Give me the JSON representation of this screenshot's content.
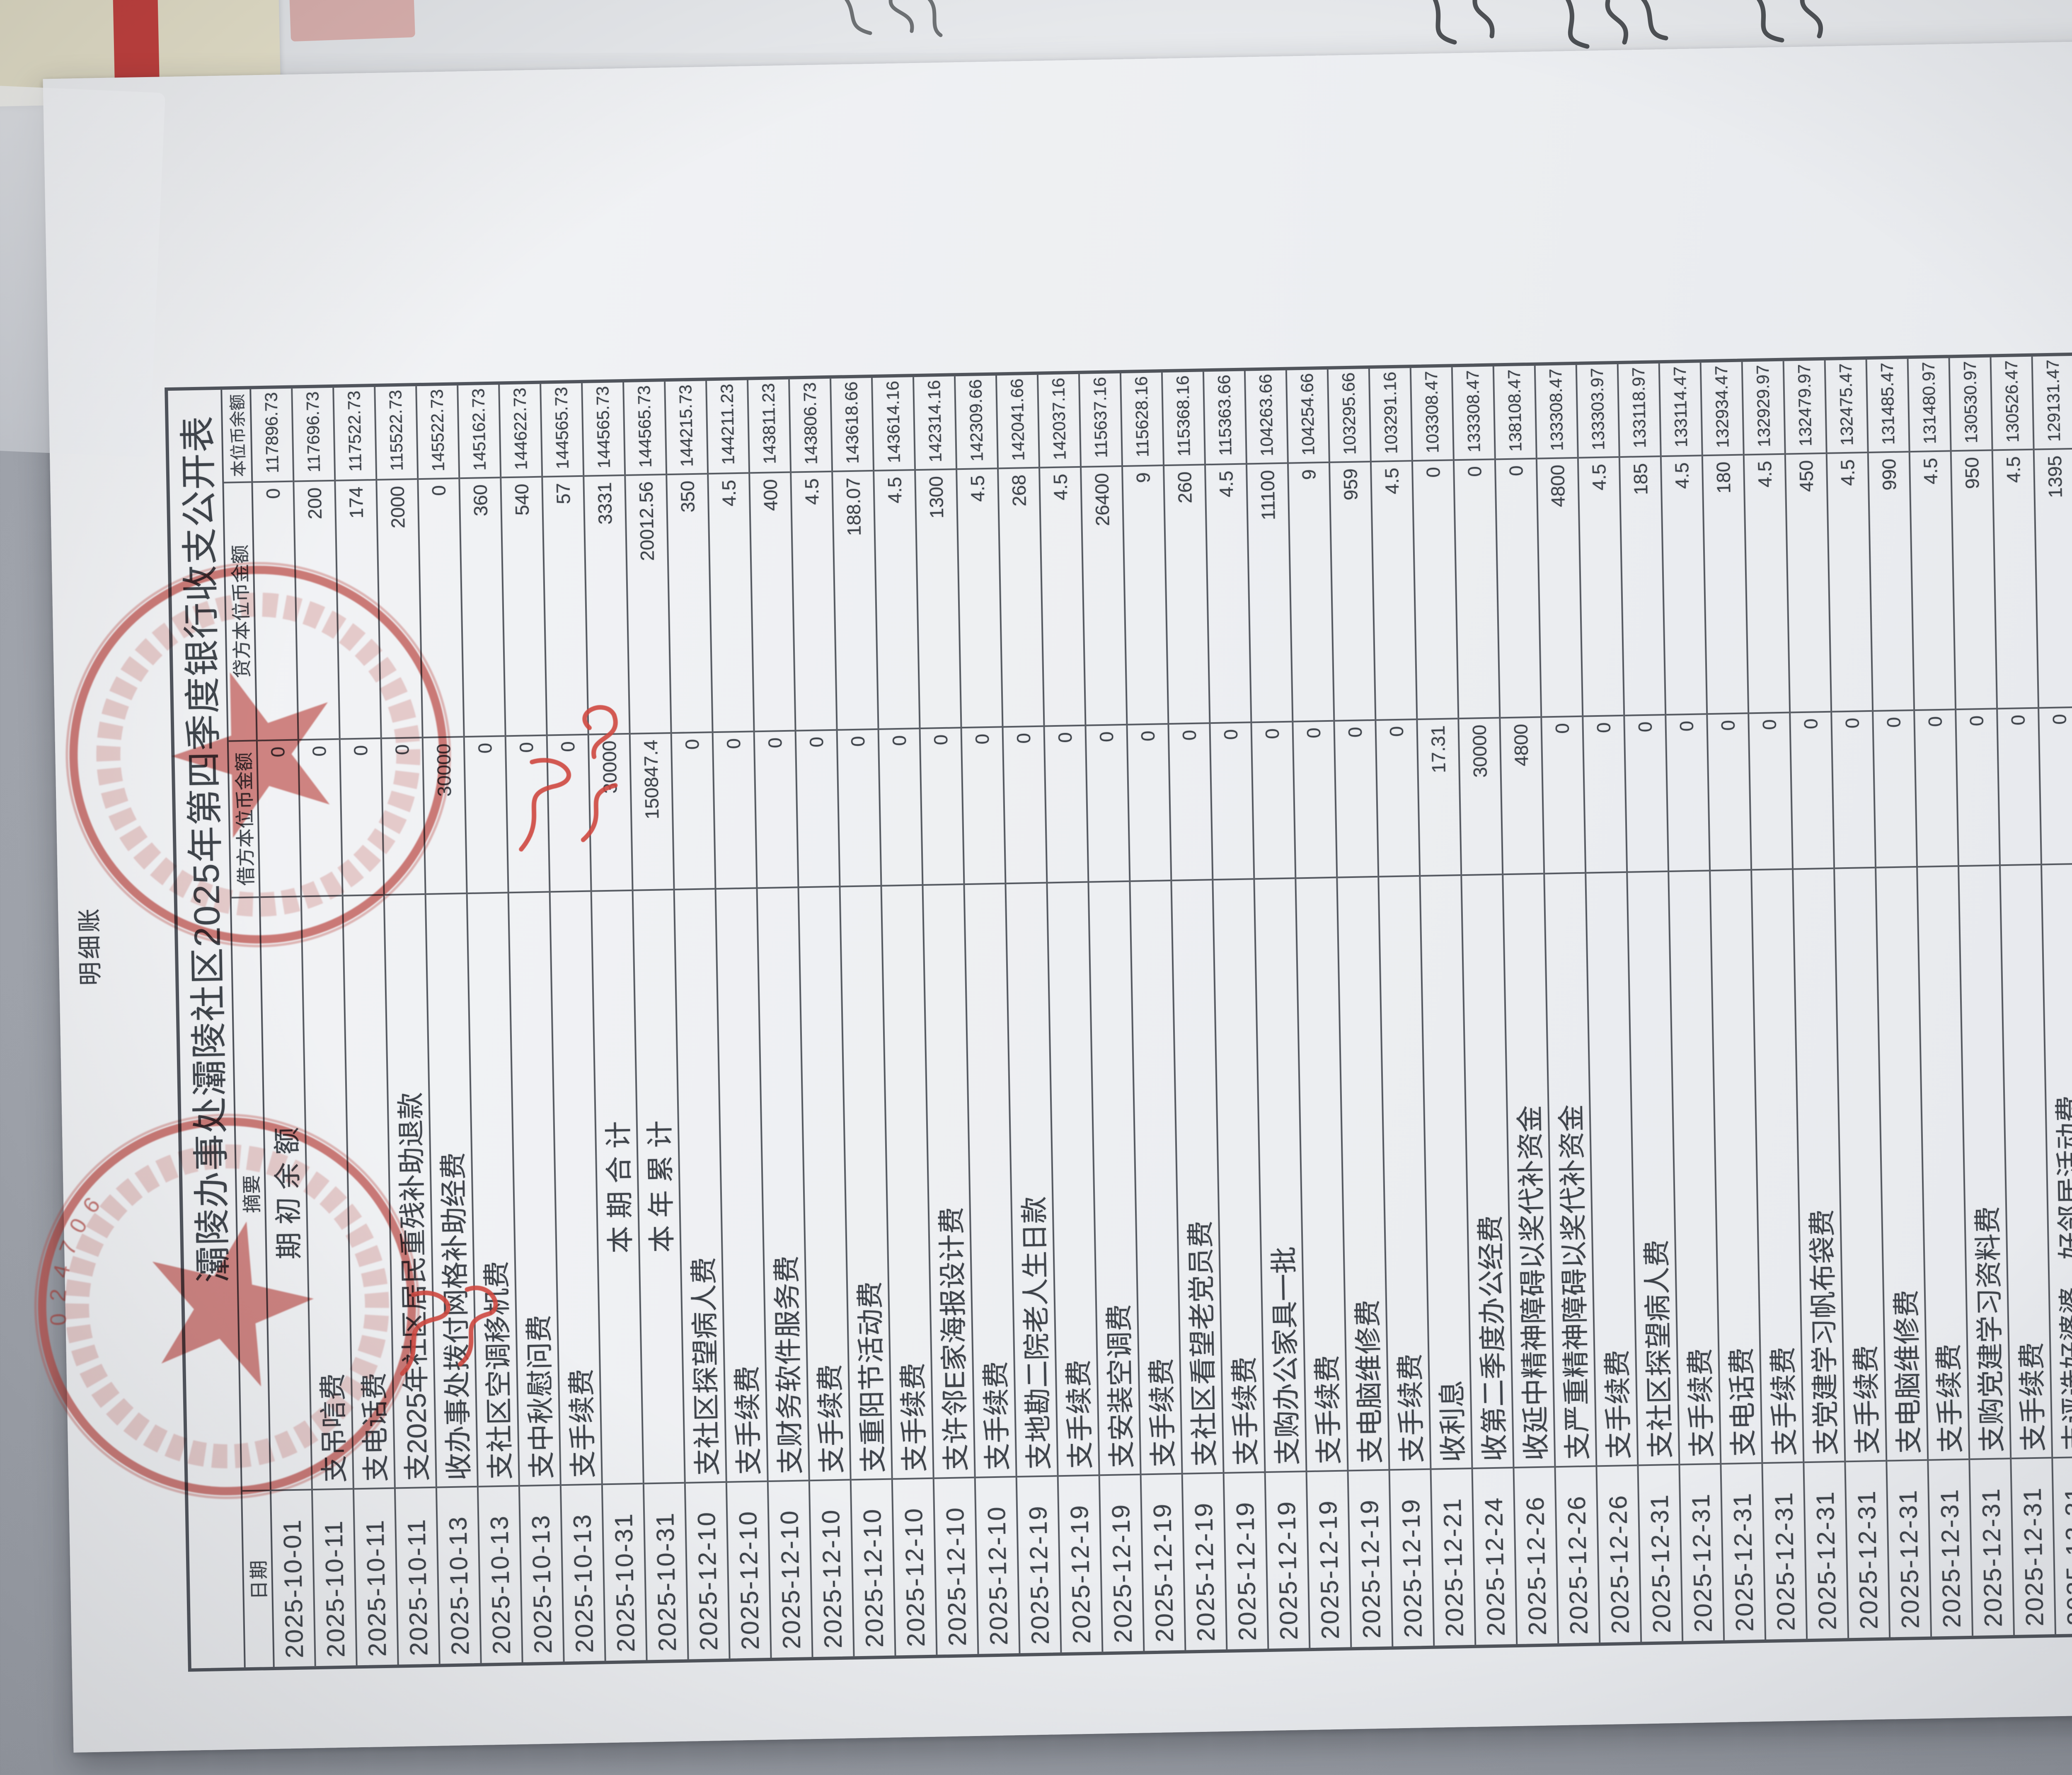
{
  "document": {
    "title": "灞陵办事处灞陵社区2025年第四季度银行收支公开表",
    "columns": [
      "日期",
      "摘要",
      "借方本位币金额",
      "贷方本位币金额",
      "本位币余额"
    ],
    "rows": [
      {
        "date": "2025-10-01",
        "summary": "期 初 余 额",
        "debit": "0",
        "credit": "0",
        "balance": "117896.73",
        "center": true
      },
      {
        "date": "2025-10-11",
        "summary": "支吊唁费",
        "debit": "0",
        "credit": "200",
        "balance": "117696.73"
      },
      {
        "date": "2025-10-11",
        "summary": "支电话费",
        "debit": "0",
        "credit": "174",
        "balance": "117522.73"
      },
      {
        "date": "2025-10-11",
        "summary": "支2025年社区居民重残补助退款",
        "debit": "0",
        "credit": "2000",
        "balance": "115522.73"
      },
      {
        "date": "2025-10-13",
        "summary": "收办事处拨付网格补助经费",
        "debit": "30000",
        "credit": "0",
        "balance": "145522.73"
      },
      {
        "date": "2025-10-13",
        "summary": "支社区空调移机费",
        "debit": "0",
        "credit": "360",
        "balance": "145162.73"
      },
      {
        "date": "2025-10-13",
        "summary": "支中秋慰问费",
        "debit": "0",
        "credit": "540",
        "balance": "144622.73"
      },
      {
        "date": "2025-10-13",
        "summary": "支手续费",
        "debit": "0",
        "credit": "57",
        "balance": "144565.73"
      },
      {
        "date": "2025-10-31",
        "summary": "本 期 合 计",
        "debit": "30000",
        "credit": "3331",
        "balance": "144565.73",
        "center": true
      },
      {
        "date": "2025-10-31",
        "summary": "本 年 累 计",
        "debit": "150847.4",
        "credit": "20012.56",
        "balance": "144565.73",
        "center": true
      },
      {
        "date": "2025-12-10",
        "summary": "支社区探望病人费",
        "debit": "0",
        "credit": "350",
        "balance": "144215.73"
      },
      {
        "date": "2025-12-10",
        "summary": "支手续费",
        "debit": "0",
        "credit": "4.5",
        "balance": "144211.23"
      },
      {
        "date": "2025-12-10",
        "summary": "支财务软件服务费",
        "debit": "0",
        "credit": "400",
        "balance": "143811.23"
      },
      {
        "date": "2025-12-10",
        "summary": "支手续费",
        "debit": "0",
        "credit": "4.5",
        "balance": "143806.73"
      },
      {
        "date": "2025-12-10",
        "summary": "支重阳节活动费",
        "debit": "0",
        "credit": "188.07",
        "balance": "143618.66"
      },
      {
        "date": "2025-12-10",
        "summary": "支手续费",
        "debit": "0",
        "credit": "4.5",
        "balance": "143614.16"
      },
      {
        "date": "2025-12-10",
        "summary": "支许邻E家海报设计费",
        "debit": "0",
        "credit": "1300",
        "balance": "142314.16"
      },
      {
        "date": "2025-12-10",
        "summary": "支手续费",
        "debit": "0",
        "credit": "4.5",
        "balance": "142309.66"
      },
      {
        "date": "2025-12-19",
        "summary": "支地勘二院老人生日款",
        "debit": "0",
        "credit": "268",
        "balance": "142041.66"
      },
      {
        "date": "2025-12-19",
        "summary": "支手续费",
        "debit": "0",
        "credit": "4.5",
        "balance": "142037.16"
      },
      {
        "date": "2025-12-19",
        "summary": "支安装空调费",
        "debit": "0",
        "credit": "26400",
        "balance": "115637.16"
      },
      {
        "date": "2025-12-19",
        "summary": "支手续费",
        "debit": "0",
        "credit": "9",
        "balance": "115628.16"
      },
      {
        "date": "2025-12-19",
        "summary": "支社区看望老党员费",
        "debit": "0",
        "credit": "260",
        "balance": "115368.16"
      },
      {
        "date": "2025-12-19",
        "summary": "支手续费",
        "debit": "0",
        "credit": "4.5",
        "balance": "115363.66"
      },
      {
        "date": "2025-12-19",
        "summary": "支购办公家具一批",
        "debit": "0",
        "credit": "11100",
        "balance": "104263.66"
      },
      {
        "date": "2025-12-19",
        "summary": "支手续费",
        "debit": "0",
        "credit": "9",
        "balance": "104254.66"
      },
      {
        "date": "2025-12-19",
        "summary": "支电脑维修费",
        "debit": "0",
        "credit": "959",
        "balance": "103295.66"
      },
      {
        "date": "2025-12-19",
        "summary": "支手续费",
        "debit": "0",
        "credit": "4.5",
        "balance": "103291.16"
      },
      {
        "date": "2025-12-21",
        "summary": "收利息",
        "debit": "17.31",
        "credit": "0",
        "balance": "103308.47"
      },
      {
        "date": "2025-12-24",
        "summary": "收第二季度办公经费",
        "debit": "30000",
        "credit": "0",
        "balance": "133308.47"
      },
      {
        "date": "2025-12-26",
        "summary": "收延中精神障碍以奖代补资金",
        "debit": "4800",
        "credit": "0",
        "balance": "138108.47"
      },
      {
        "date": "2025-12-26",
        "summary": "支严重精神障碍以奖代补资金",
        "debit": "0",
        "credit": "4800",
        "balance": "133308.47"
      },
      {
        "date": "2025-12-26",
        "summary": "支手续费",
        "debit": "0",
        "credit": "4.5",
        "balance": "133303.97"
      },
      {
        "date": "2025-12-31",
        "summary": "支社区探望病人费",
        "debit": "0",
        "credit": "185",
        "balance": "133118.97"
      },
      {
        "date": "2025-12-31",
        "summary": "支手续费",
        "debit": "0",
        "credit": "4.5",
        "balance": "133114.47"
      },
      {
        "date": "2025-12-31",
        "summary": "支电话费",
        "debit": "0",
        "credit": "180",
        "balance": "132934.47"
      },
      {
        "date": "2025-12-31",
        "summary": "支手续费",
        "debit": "0",
        "credit": "4.5",
        "balance": "132929.97"
      },
      {
        "date": "2025-12-31",
        "summary": "支党建学习帆布袋费",
        "debit": "0",
        "credit": "450",
        "balance": "132479.97"
      },
      {
        "date": "2025-12-31",
        "summary": "支手续费",
        "debit": "0",
        "credit": "4.5",
        "balance": "132475.47"
      },
      {
        "date": "2025-12-31",
        "summary": "支电脑维修费",
        "debit": "0",
        "credit": "990",
        "balance": "131485.47"
      },
      {
        "date": "2025-12-31",
        "summary": "支手续费",
        "debit": "0",
        "credit": "4.5",
        "balance": "131480.97"
      },
      {
        "date": "2025-12-31",
        "summary": "支购党建学习资料费",
        "debit": "0",
        "credit": "950",
        "balance": "130530.97"
      },
      {
        "date": "2025-12-31",
        "summary": "支手续费",
        "debit": "0",
        "credit": "4.5",
        "balance": "130526.47"
      },
      {
        "date": "2025-12-31",
        "summary": "支评选好婆婆、好邻居活动费",
        "debit": "0",
        "credit": "1395",
        "balance": "129131.47"
      },
      {
        "date": "2025-12-31",
        "summary": "支手续费",
        "debit": "0",
        "credit": "4.5",
        "balance": "129126.97"
      },
      {
        "date": "2025-12-31",
        "summary": "本 期 合 计",
        "debit": "34817.31",
        "credit": "50256.07",
        "balance": "129126.97",
        "center": true
      },
      {
        "date": "2025-12-31",
        "summary": "本 年 累 计",
        "debit": "185664.71",
        "credit": "70268.63",
        "balance": "129126.97",
        "center": true
      },
      {
        "date": "2025-12-31",
        "summary": "结 转 下 年",
        "debit": "0",
        "credit": "0",
        "balance": "129126.97",
        "center": true
      }
    ]
  },
  "footer": {
    "left": "明细账",
    "right": "Page 1"
  },
  "stamps": {
    "code": "024706",
    "color": "#c4453f"
  }
}
